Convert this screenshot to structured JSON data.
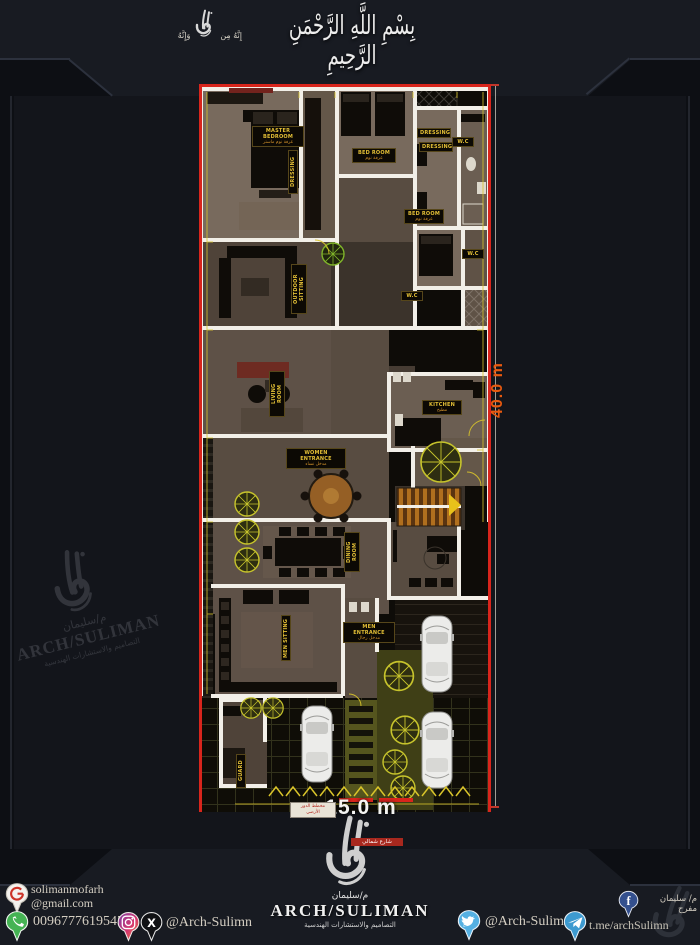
{
  "header": {
    "bismillah": "بِسْمِ اللَّهِ الرَّحْمَنِ الرَّحِيمِ",
    "seal_left": "إِنَّهُ مِن",
    "seal_right": "وَإِنَّهُ"
  },
  "plan": {
    "width_label": "15.0 m",
    "height_label": "40.0 m",
    "title_badge_line1": "مخطط الدور",
    "title_badge_line2": "الأرضي",
    "street_label": "شارع شمالي",
    "labels": {
      "master_bedroom": {
        "en": "MASTER BEDROOM",
        "ar": "غرفة نوم ماستر"
      },
      "bedroom": {
        "en": "BED ROOM",
        "ar": "غرفة نوم"
      },
      "dressing": {
        "en": "DRESSING"
      },
      "wc": {
        "en": "W.C"
      },
      "outdoor_sitting": {
        "en": "OUTDOOR SITTING",
        "ar": "جلسة خارجية"
      },
      "living_room": {
        "en": "LIVING ROOM",
        "ar": "غرفة معيشة"
      },
      "kitchen": {
        "en": "KITCHEN",
        "ar": "مطبخ"
      },
      "women_entrance": {
        "en": "WOMEN ENTRANCE",
        "ar": "مدخل نساء"
      },
      "dining_room": {
        "en": "DINING ROOM",
        "ar": "غرفة طعام"
      },
      "men_sitting": {
        "en": "MEN SITTING",
        "ar": "مجلس رجال"
      },
      "men_entrance": {
        "en": "MEN ENTRANCE",
        "ar": "مدخل رجال"
      },
      "guard": {
        "en": "GUARD"
      }
    }
  },
  "brand": {
    "name_ar": "م/سليمان",
    "name_en": "ARCH/SULIMAN",
    "subtitle_ar": "التصاميم والاستشارات الهندسية"
  },
  "watermark": {
    "name_ar": "م/سليمان",
    "name_en": "ARCH/SULIMAN",
    "subtitle_ar": "التصاميم والاستشارات الهندسية"
  },
  "footer": {
    "email_user": "solimanmofarh",
    "email_domain": "@gmail.com",
    "phone": "00967776195453",
    "handle_left": "@Arch-Sulimn",
    "handle_right": "@Arch-Sulimn",
    "telegram": "t.me/archSulimn",
    "facebook_name": "م/ سليمان مفرح",
    "icons": {
      "gmail_glyph": "G",
      "x_glyph": "X",
      "facebook_glyph": "f"
    }
  },
  "colors": {
    "boundary_red": "#d8251c",
    "annotation_yellow": "#d9c42a",
    "dimension_orange": "#e8590f",
    "wall_white": "#f2efe8"
  }
}
